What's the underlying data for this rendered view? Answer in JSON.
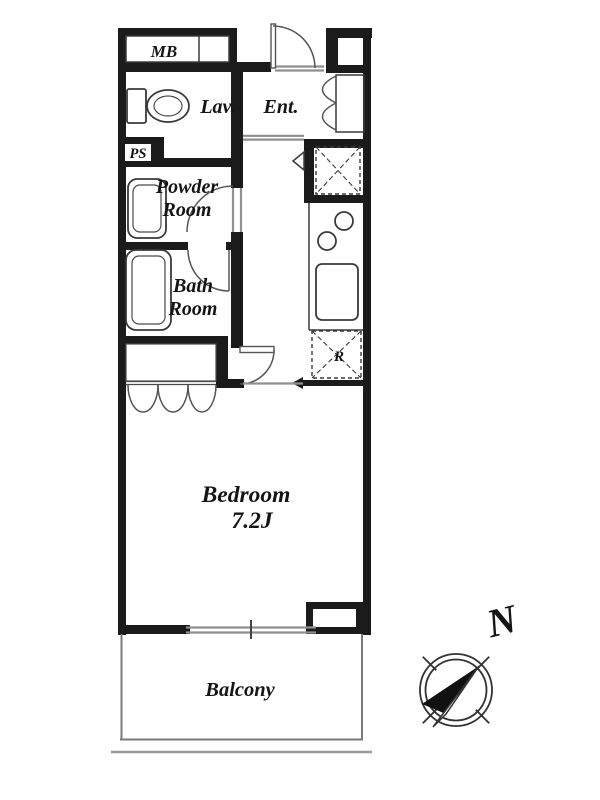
{
  "floorplan": {
    "labels": {
      "mb": "MB",
      "lav": "Lav.",
      "ent": "Ent.",
      "ps": "PS",
      "powder_room_line1": "Powder",
      "powder_room_line2": "Room",
      "bath_room_line1": "Bath",
      "bath_room_line2": "Room",
      "refrigerator": "R",
      "bedroom_name": "Bedroom",
      "bedroom_size": "7.2J",
      "balcony": "Balcony"
    },
    "compass": {
      "north": "N"
    },
    "colors": {
      "wall": "#1b1b1b",
      "fixture_line": "#3a3a3a",
      "glass_line": "#8f8f8f",
      "background": "#ffffff",
      "text": "#151515"
    }
  }
}
